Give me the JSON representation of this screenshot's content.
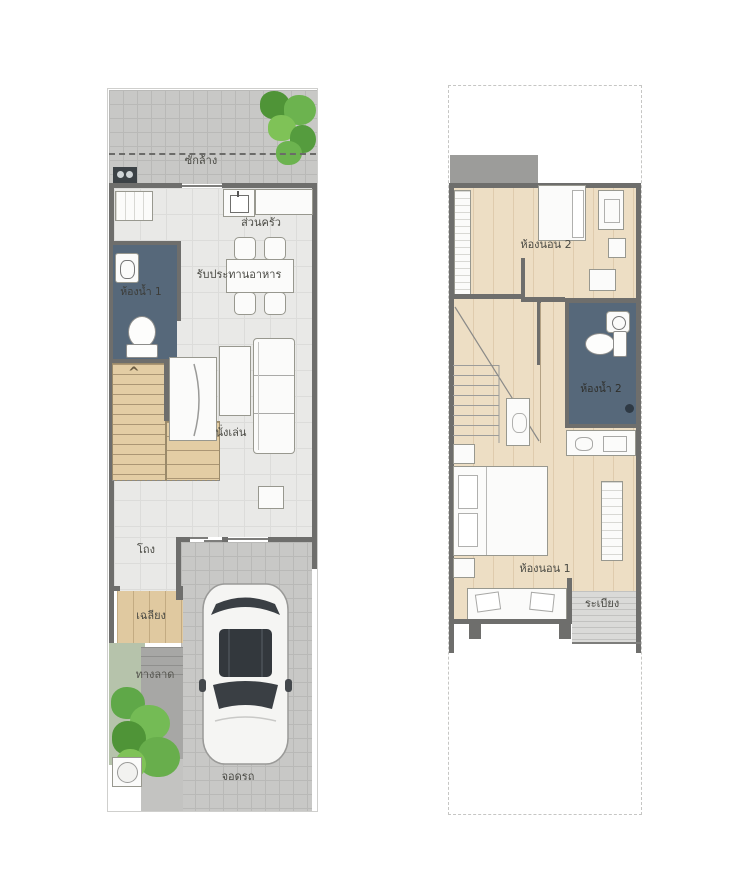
{
  "title": "Townhouse floor plans (2 storeys)",
  "colors": {
    "wall": "#6e6e6c",
    "bathroom_floor": "#56687a",
    "wood_stairs": "#e3cda4",
    "wood_floor_2f": "#eddec4",
    "tile_gray": "#c8c8c6",
    "floor_gray": "#e9e9e7",
    "plant_green": "#5fa848",
    "label_text": "#4a4a44"
  },
  "floor1": {
    "labels": {
      "laundry": "ซักล้าง",
      "kitchen": "ส่วนครัว",
      "dining": "รับประทานอาหาร",
      "bathroom1": "ห้องน้ำ 1",
      "living": "นั่งเล่น",
      "hall": "โถง",
      "porch": "เฉลียง",
      "ramp": "ทางลาด",
      "parking": "จอดรถ"
    }
  },
  "floor2": {
    "labels": {
      "bedroom2": "ห้องนอน 2",
      "bathroom2": "ห้องน้ำ 2",
      "bedroom1": "ห้องนอน 1",
      "balcony": "ระเบียง"
    }
  },
  "icons": {
    "stair_up_arrow": "^"
  }
}
